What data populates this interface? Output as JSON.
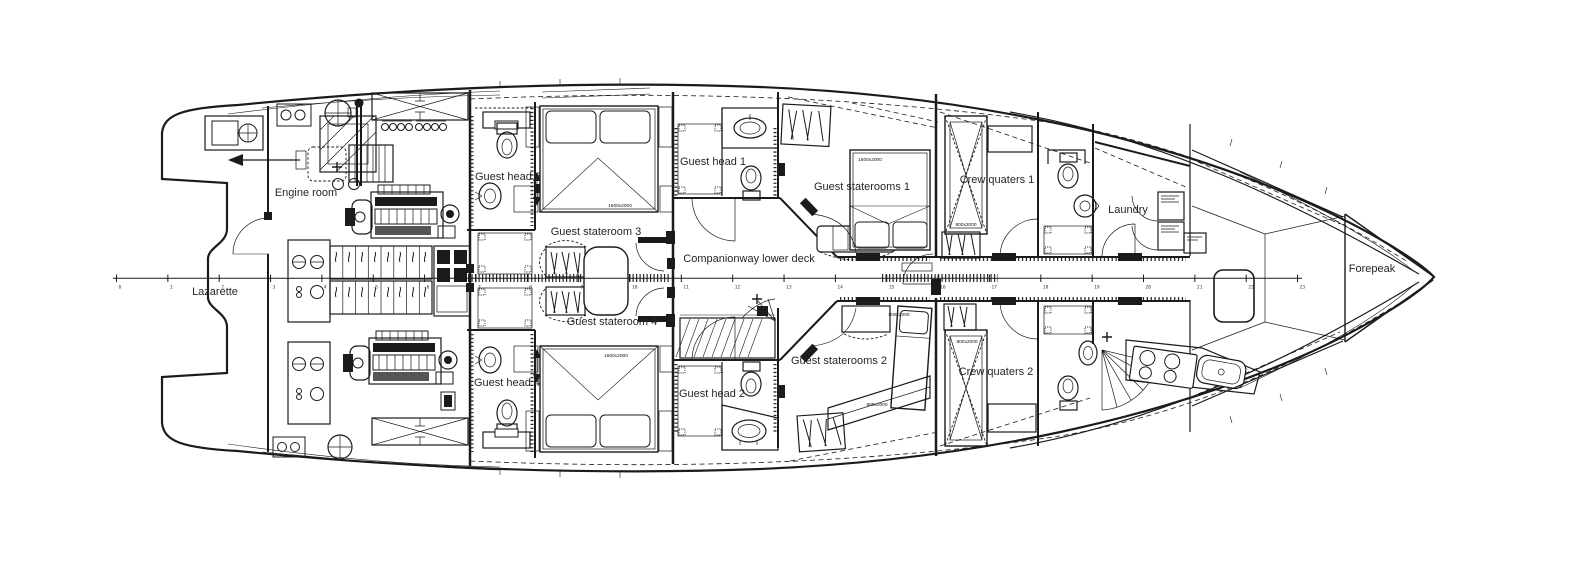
{
  "drawing": {
    "title": "Yacht lower deck general arrangement plan",
    "rooms": {
      "lazarette": "Lazarette",
      "engine_room": "Engine room",
      "guest_head_3": "Guest head 3",
      "guest_stateroom_3": "Guest stateroom 3",
      "guest_head_4": "Guest head 4",
      "guest_stateroom_4": "Guest stateroom 4",
      "guest_head_1": "Guest head 1",
      "guest_staterooms_1": "Guest staterooms 1",
      "companionway": "Companionway lower deck",
      "guest_head_2": "Guest head 2",
      "guest_staterooms_2": "Guest staterooms 2",
      "crew_quaters_1": "Crew quaters 1",
      "crew_quaters_2": "Crew quaters 2",
      "laundry": "Laundry",
      "forepeak": "Forepeak"
    },
    "bed_dimensions": {
      "guest_stateroom_3": "1600x2000",
      "guest_stateroom_4": "1600x2000",
      "guest_staterooms_1": "1600x2000",
      "guest_staterooms_2_upper": "800x2000",
      "guest_staterooms_2_lower": "800x2000",
      "crew_quaters_1": "800x2000",
      "crew_quaters_2": "800x2000"
    },
    "ruler": {
      "ticks": [
        "0",
        "1",
        "2",
        "3",
        "4",
        "5",
        "6",
        "7",
        "8",
        "9",
        "10",
        "11",
        "12",
        "13",
        "14",
        "15",
        "16",
        "17",
        "18",
        "19",
        "20",
        "21",
        "22",
        "23"
      ]
    },
    "colors": {
      "line": "#1b1b1b",
      "background": "#ffffff"
    }
  }
}
